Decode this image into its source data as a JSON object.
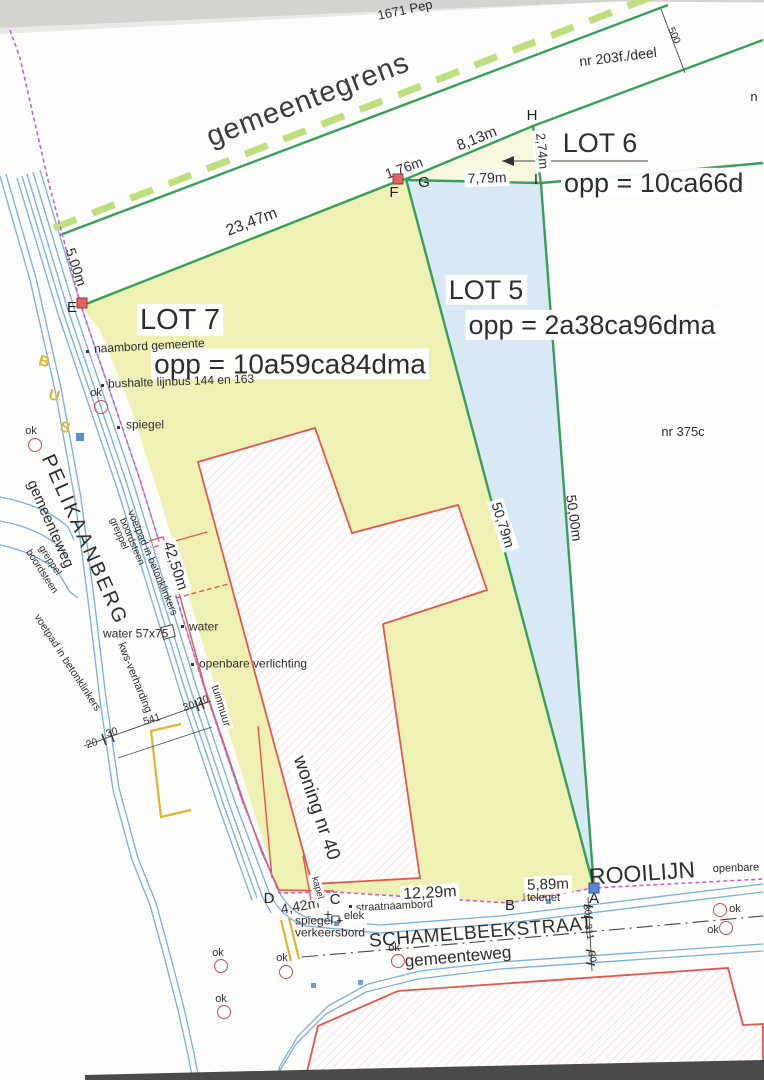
{
  "colors": {
    "green_boundary": "#35a05a",
    "dash_green": "#bfdf7f",
    "lot7_fill": "#eef0b4",
    "lot5_fill": "#d9e8f5",
    "lot6_fill": "#f7f7e0",
    "road_blue": "#79b0dc",
    "rooilijn_magenta": "#c75fd2",
    "wall_red": "#e2574d",
    "bus_yellow": "#ddb52f",
    "hatch_pink": "#f2c5c2",
    "marker_red": "#e06262",
    "marker_blue": "#5b85d6",
    "ok_red": "#c84b5e"
  },
  "labels": {
    "lots": [
      {
        "n": "lot7-title",
        "t": "LOT 7",
        "x": 180,
        "y": 320,
        "s": 29,
        "bg": true
      },
      {
        "n": "lot7-area",
        "t": "opp = 10a59ca84dma",
        "x": 290,
        "y": 364,
        "s": 28,
        "bg": true
      },
      {
        "n": "lot5-title",
        "t": "LOT 5",
        "x": 486,
        "y": 290,
        "s": 27,
        "bg": true
      },
      {
        "n": "lot5-area",
        "t": "opp = 2a38ca96dma",
        "x": 592,
        "y": 325,
        "s": 27,
        "bg": true
      },
      {
        "n": "lot6-title",
        "t": "LOT 6",
        "x": 600,
        "y": 143,
        "s": 27,
        "bg": true
      },
      {
        "n": "lot6-area",
        "t": "opp = 10ca66d",
        "x": 561,
        "y": 183,
        "s": 27,
        "a": "l",
        "bg": true
      }
    ],
    "parcels": [
      {
        "n": "parcel-nr203f",
        "t": "nr 203f./deel",
        "x": 618,
        "y": 57,
        "s": 14,
        "r": -7
      },
      {
        "n": "parcel-nr375c",
        "t": "nr 375c",
        "x": 683,
        "y": 432,
        "s": 13
      },
      {
        "n": "parcel-1671-pep",
        "t": "1671 Pep",
        "x": 405,
        "y": 10,
        "s": 13,
        "r": -12
      },
      {
        "n": "parcel-nr-cut",
        "t": "n",
        "x": 754,
        "y": 97,
        "s": 13
      }
    ],
    "streets": [
      {
        "n": "gemeentegrens-label",
        "t": "gemeentegrens",
        "x": 308,
        "y": 100,
        "s": 29,
        "r": -21,
        "c": "#3c3c3c",
        "ls": 1
      },
      {
        "n": "street-pelikaanberg",
        "t": "PELIKAANBERG",
        "x": 84,
        "y": 540,
        "s": 20,
        "r": 66,
        "ls": 2.5
      },
      {
        "n": "street-gemeenteweg-left",
        "t": "gemeenteweg",
        "x": 50,
        "y": 524,
        "s": 15,
        "r": 66
      },
      {
        "n": "street-schamelbeekstraat",
        "t": "SCHAMELBEEKSTRAAT",
        "x": 481,
        "y": 933,
        "s": 19,
        "r": -4.5,
        "ls": 0.5
      },
      {
        "n": "street-gemeenteweg-bottom",
        "t": "gemeenteweg",
        "x": 458,
        "y": 957,
        "s": 17,
        "r": -5
      },
      {
        "n": "rooilijn-label",
        "t": "ROOILIJN",
        "x": 642,
        "y": 873,
        "s": 23,
        "r": -4
      },
      {
        "n": "openbare-label",
        "t": "openbare",
        "x": 736,
        "y": 869,
        "s": 11,
        "r": -2
      },
      {
        "n": "bus-letter-b",
        "t": "B",
        "x": 44,
        "y": 362,
        "s": 15,
        "r": 15,
        "c": "#ddb52f",
        "w": 700
      },
      {
        "n": "bus-letter-u",
        "t": "U",
        "x": 54,
        "y": 396,
        "s": 15,
        "r": 15,
        "c": "#ddb52f",
        "w": 700
      },
      {
        "n": "bus-letter-s",
        "t": "S",
        "x": 65,
        "y": 428,
        "s": 15,
        "r": 15,
        "c": "#ddb52f",
        "w": 700
      }
    ],
    "measurements": [
      {
        "n": "dim-5-00",
        "t": "5,00m",
        "x": 76,
        "y": 267,
        "s": 14,
        "r": 72
      },
      {
        "n": "dim-23-47",
        "t": "23,47m",
        "x": 252,
        "y": 223,
        "s": 16,
        "r": -21
      },
      {
        "n": "dim-1-76",
        "t": "1,76m",
        "x": 404,
        "y": 168,
        "s": 14,
        "r": -20,
        "bg": true
      },
      {
        "n": "dim-8-13",
        "t": "8,13m",
        "x": 477,
        "y": 139,
        "s": 15,
        "r": -22
      },
      {
        "n": "dim-7-79",
        "t": "7,79m",
        "x": 487,
        "y": 178,
        "s": 14,
        "r": -2,
        "bg": true
      },
      {
        "n": "dim-2-74",
        "t": "2,74m",
        "x": 542,
        "y": 151,
        "s": 13,
        "r": 84,
        "bg": true
      },
      {
        "n": "dim-42-50",
        "t": "42,50m",
        "x": 175,
        "y": 566,
        "s": 15,
        "r": 72,
        "bg": true
      },
      {
        "n": "dim-50-79",
        "t": "50,79m",
        "x": 503,
        "y": 525,
        "s": 14,
        "r": 72,
        "bg": true
      },
      {
        "n": "dim-50-00",
        "t": "50,00m",
        "x": 574,
        "y": 518,
        "s": 14,
        "r": 82
      },
      {
        "n": "dim-12-29",
        "t": "12,29m",
        "x": 430,
        "y": 894,
        "s": 16,
        "r": -3,
        "bg": true
      },
      {
        "n": "dim-5-89",
        "t": "5,89m",
        "x": 548,
        "y": 885,
        "s": 15,
        "r": -2,
        "bg": true
      },
      {
        "n": "dim-4-42",
        "t": "4,42m",
        "x": 300,
        "y": 906,
        "s": 14,
        "r": -10
      },
      {
        "n": "dim-500",
        "t": "500",
        "x": 673,
        "y": 36,
        "s": 10,
        "r": 65
      },
      {
        "n": "dim-20-left",
        "t": "20",
        "x": 92,
        "y": 744,
        "s": 10.5,
        "r": -17
      },
      {
        "n": "dim-30-left",
        "t": "30",
        "x": 112,
        "y": 733,
        "s": 10.5,
        "r": -17
      },
      {
        "n": "dim-541",
        "t": "541",
        "x": 152,
        "y": 720,
        "s": 10.5,
        "r": -17
      },
      {
        "n": "dim-30-right",
        "t": "30",
        "x": 189,
        "y": 707,
        "s": 10.5,
        "r": -17
      },
      {
        "n": "dim-20-right",
        "t": "20",
        "x": 203,
        "y": 701,
        "s": 10.5,
        "r": -17
      },
      {
        "n": "dim-30-a-top",
        "t": "30",
        "x": 586,
        "y": 910,
        "s": 10,
        "r": 80
      },
      {
        "n": "dim-311",
        "t": "311",
        "x": 588,
        "y": 932,
        "s": 10,
        "r": 80
      },
      {
        "n": "dim-30-a-bottom",
        "t": "30",
        "x": 591,
        "y": 957,
        "s": 10,
        "r": 80
      }
    ],
    "annotations": [
      {
        "n": "note-naambord",
        "t": "naambord gemeente",
        "x": 94,
        "y": 349,
        "s": 12,
        "r": -3,
        "a": "l"
      },
      {
        "n": "note-bushalte",
        "t": "bushalte lijnbus 144 en 163",
        "x": 108,
        "y": 384,
        "s": 12,
        "r": -2,
        "a": "l"
      },
      {
        "n": "note-spiegel-top",
        "t": "spiegel",
        "x": 126,
        "y": 425,
        "s": 12,
        "a": "l"
      },
      {
        "n": "note-water-57x75",
        "t": "water 57x75",
        "x": 103,
        "y": 634,
        "s": 12,
        "a": "l"
      },
      {
        "n": "note-water",
        "t": "water",
        "x": 189,
        "y": 627,
        "s": 12,
        "a": "l"
      },
      {
        "n": "note-openbare-verlichting",
        "t": "openbare verlichting",
        "x": 199,
        "y": 664,
        "s": 12,
        "a": "l"
      },
      {
        "n": "note-tuinmuur",
        "t": "tuinmuur",
        "x": 220,
        "y": 706,
        "s": 11,
        "r": 73,
        "bg": true
      },
      {
        "n": "note-kws-verharding",
        "t": "kws-verharding",
        "x": 134,
        "y": 678,
        "s": 11,
        "r": 68
      },
      {
        "n": "note-greppel-main",
        "t": "greppel",
        "x": 118,
        "y": 534,
        "s": 10,
        "r": 67
      },
      {
        "n": "note-boordsteen-main",
        "t": "boordsteen",
        "x": 131,
        "y": 542,
        "s": 10,
        "r": 67
      },
      {
        "n": "note-voetpad-main",
        "t": "voetpad in betonklinkers",
        "x": 152,
        "y": 563,
        "s": 10.5,
        "r": 67
      },
      {
        "n": "note-greppel-branch",
        "t": "greppel",
        "x": 49,
        "y": 561,
        "s": 10,
        "r": 57
      },
      {
        "n": "note-boordsteen-branch",
        "t": "boordsteen",
        "x": 41,
        "y": 572,
        "s": 10,
        "r": 57
      },
      {
        "n": "note-voetpad-branch",
        "t": "voetpad in betonklinkers",
        "x": 67,
        "y": 663,
        "s": 10.5,
        "r": 57
      },
      {
        "n": "note-woning-nr40",
        "t": "woning nr 40",
        "x": 316,
        "y": 808,
        "s": 19,
        "r": 71,
        "bg": true
      },
      {
        "n": "note-kapel",
        "t": "kapel",
        "x": 317,
        "y": 888,
        "s": 9.5,
        "r": 74,
        "bg": true
      },
      {
        "n": "note-straatnaambord",
        "t": "straatnaambord",
        "x": 356,
        "y": 909,
        "s": 11,
        "r": -3,
        "a": "l"
      },
      {
        "n": "note-elek",
        "t": "elek",
        "x": 341,
        "y": 917,
        "s": 11,
        "a": "l",
        "bg": true
      },
      {
        "n": "note-spiegel-plus",
        "t": "spiegel +",
        "x": 295,
        "y": 921,
        "s": 12,
        "a": "l"
      },
      {
        "n": "note-verkeersbord",
        "t": "verkeersbord",
        "x": 295,
        "y": 933,
        "s": 12,
        "a": "l"
      },
      {
        "n": "note-telenet",
        "t": "telenet",
        "x": 527,
        "y": 899,
        "s": 11,
        "a": "l"
      }
    ]
  },
  "survey_points": [
    {
      "l": "E",
      "x": 72,
      "y": 308,
      "m": {
        "x": 82,
        "y": 303,
        "c": "red"
      }
    },
    {
      "l": "F",
      "x": 394,
      "y": 193,
      "m": {
        "x": 398,
        "y": 179,
        "c": "red"
      }
    },
    {
      "l": "G",
      "x": 424,
      "y": 183
    },
    {
      "l": "H",
      "x": 532,
      "y": 116
    },
    {
      "l": "I",
      "x": 536,
      "y": 180
    },
    {
      "l": "A",
      "x": 594,
      "y": 899,
      "m": {
        "x": 594,
        "y": 888,
        "c": "blue"
      }
    },
    {
      "l": "B",
      "x": 510,
      "y": 906
    },
    {
      "l": "C",
      "x": 335,
      "y": 900
    },
    {
      "l": "D",
      "x": 269,
      "y": 899
    }
  ],
  "ok_markers": {
    "label": "ok",
    "items": [
      {
        "cx": 101,
        "cy": 407,
        "lx": 96,
        "ly": 394
      },
      {
        "cx": 35,
        "cy": 445,
        "lx": 31,
        "ly": 432
      },
      {
        "cx": 398,
        "cy": 961,
        "lx": 394,
        "ly": 949
      },
      {
        "cx": 286,
        "cy": 972,
        "lx": 282,
        "ly": 959
      },
      {
        "cx": 221,
        "cy": 966,
        "lx": 218,
        "ly": 954
      },
      {
        "cx": 224,
        "cy": 1012,
        "lx": 221,
        "ly": 1000
      },
      {
        "cx": 720,
        "cy": 910,
        "lx": 735,
        "ly": 910
      },
      {
        "cx": 726,
        "cy": 928,
        "lx": 713,
        "ly": 931
      }
    ]
  }
}
